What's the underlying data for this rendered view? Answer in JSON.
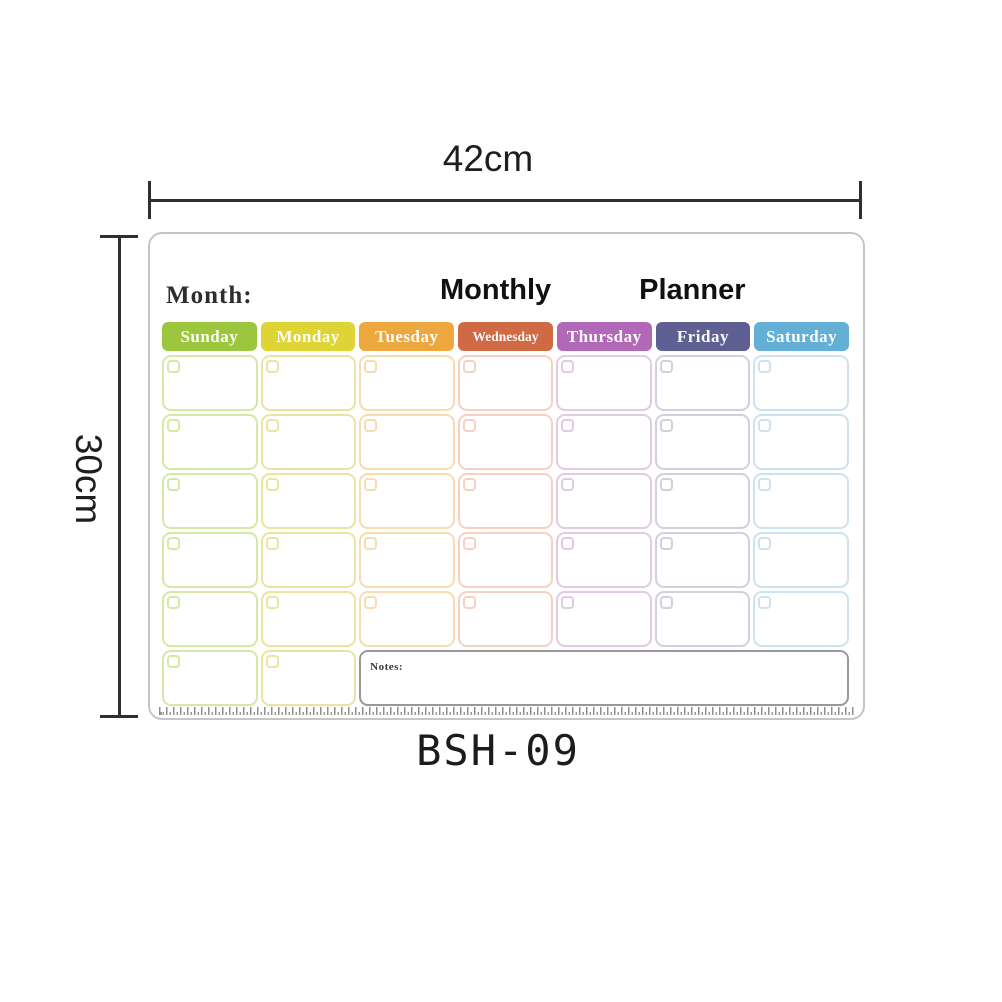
{
  "annotations": {
    "width_label": "42cm",
    "height_label": "30cm",
    "product_code": "BSH-09"
  },
  "board": {
    "month_label": "Month:",
    "title": {
      "word1": "Monthly",
      "word2": "Planner"
    },
    "notes_label": "Notes:",
    "weekdays": [
      {
        "label": "Sunday",
        "color": "#9cc63d",
        "tint": "#d6e8a6"
      },
      {
        "label": "Monday",
        "color": "#ded435",
        "tint": "#eae4a0"
      },
      {
        "label": "Tuesday",
        "color": "#eda73f",
        "tint": "#f6dcae"
      },
      {
        "label": "Wednesday",
        "color": "#d06a45",
        "tint": "#f3d2c3"
      },
      {
        "label": "Thursday",
        "color": "#b168b7",
        "tint": "#e0cbe3"
      },
      {
        "label": "Friday",
        "color": "#5d6090",
        "tint": "#d0d0df"
      },
      {
        "label": "Saturday",
        "color": "#64afd6",
        "tint": "#cde2ef"
      }
    ],
    "grid": {
      "columns": 7,
      "rows": 6,
      "last_row_day_cells": 2,
      "notes_span_columns": 5
    }
  },
  "colors": {
    "dimension_line": "#2f2f2f",
    "board_border": "#c5c5c5",
    "notes_border": "#97979d"
  }
}
